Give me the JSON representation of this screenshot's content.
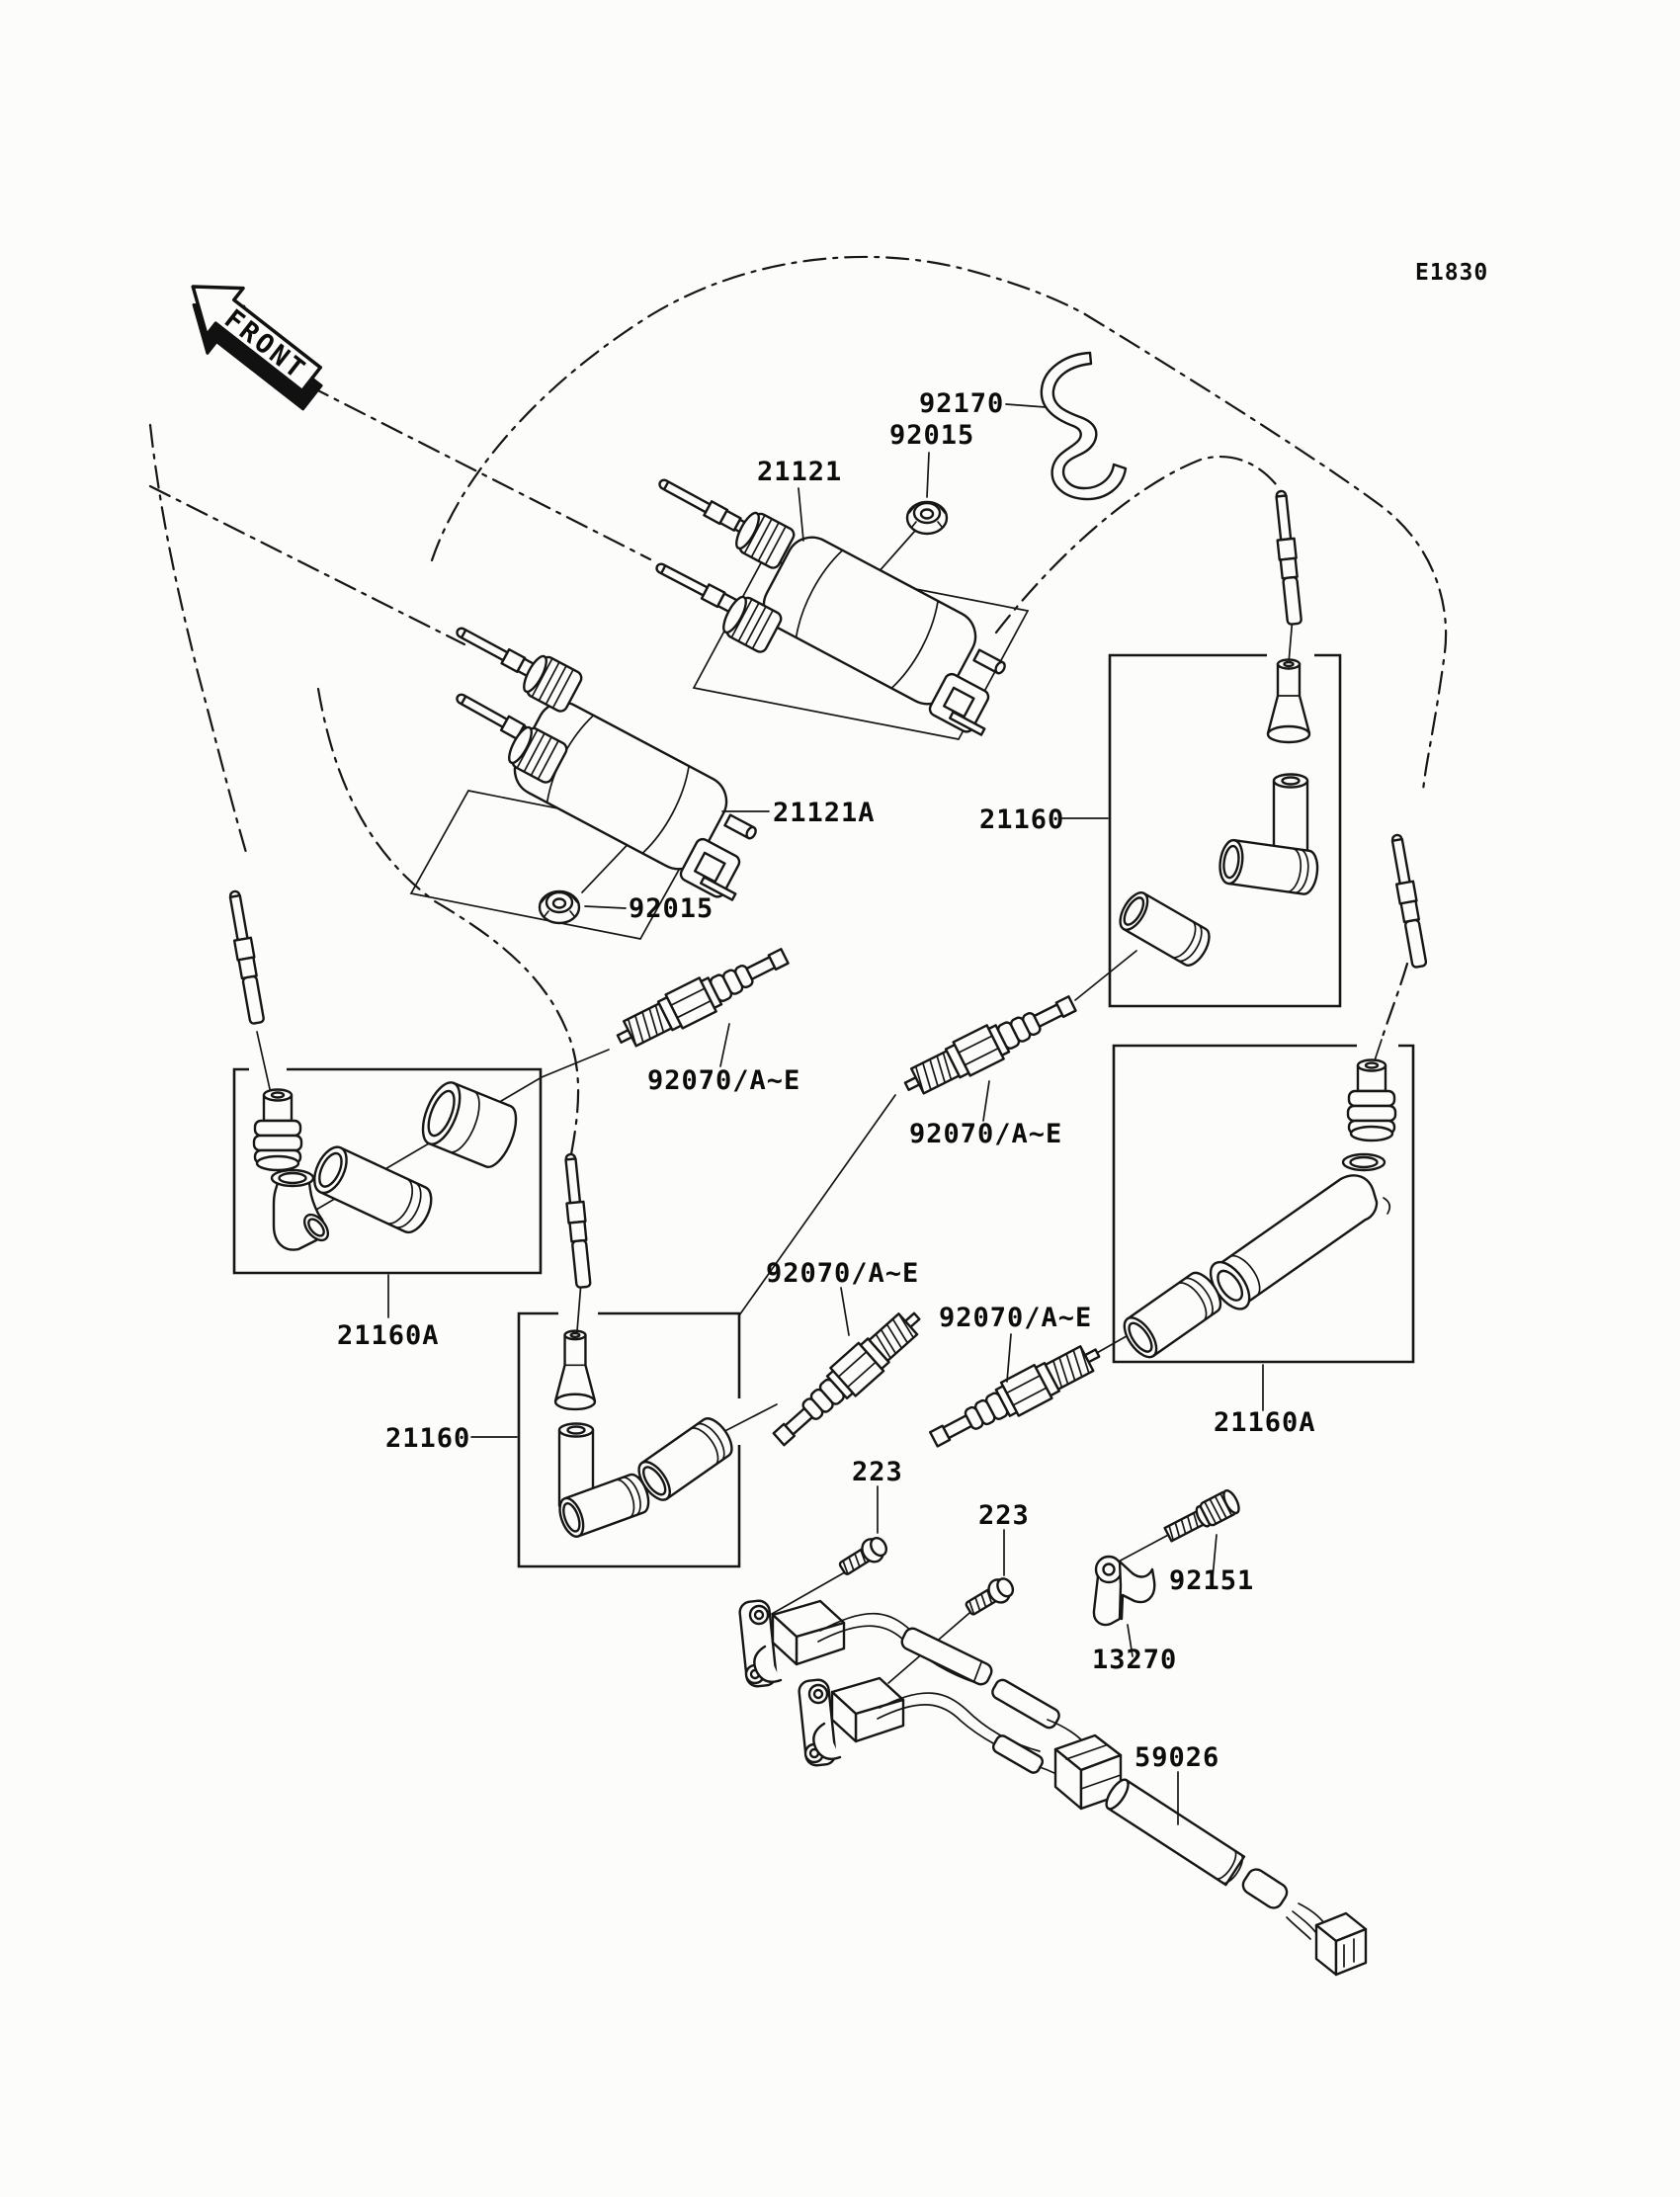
{
  "diagram": {
    "drawing_code": "E1830",
    "front_marker": "FRONT",
    "labels": {
      "l92170": "92170",
      "l92015a": "92015",
      "l21121": "21121",
      "l21121a": "21121A",
      "l92015b": "92015",
      "l21160r": "21160",
      "l21160al": "21160A",
      "l21160c": "21160",
      "l21160ar": "21160A",
      "l92070_1": "92070/A~E",
      "l92070_2": "92070/A~E",
      "l92070_3": "92070/A~E",
      "l92070_4": "92070/A~E",
      "l223_1": "223",
      "l223_2": "223",
      "l92151": "92151",
      "l13270": "13270",
      "l59026": "59026"
    }
  }
}
